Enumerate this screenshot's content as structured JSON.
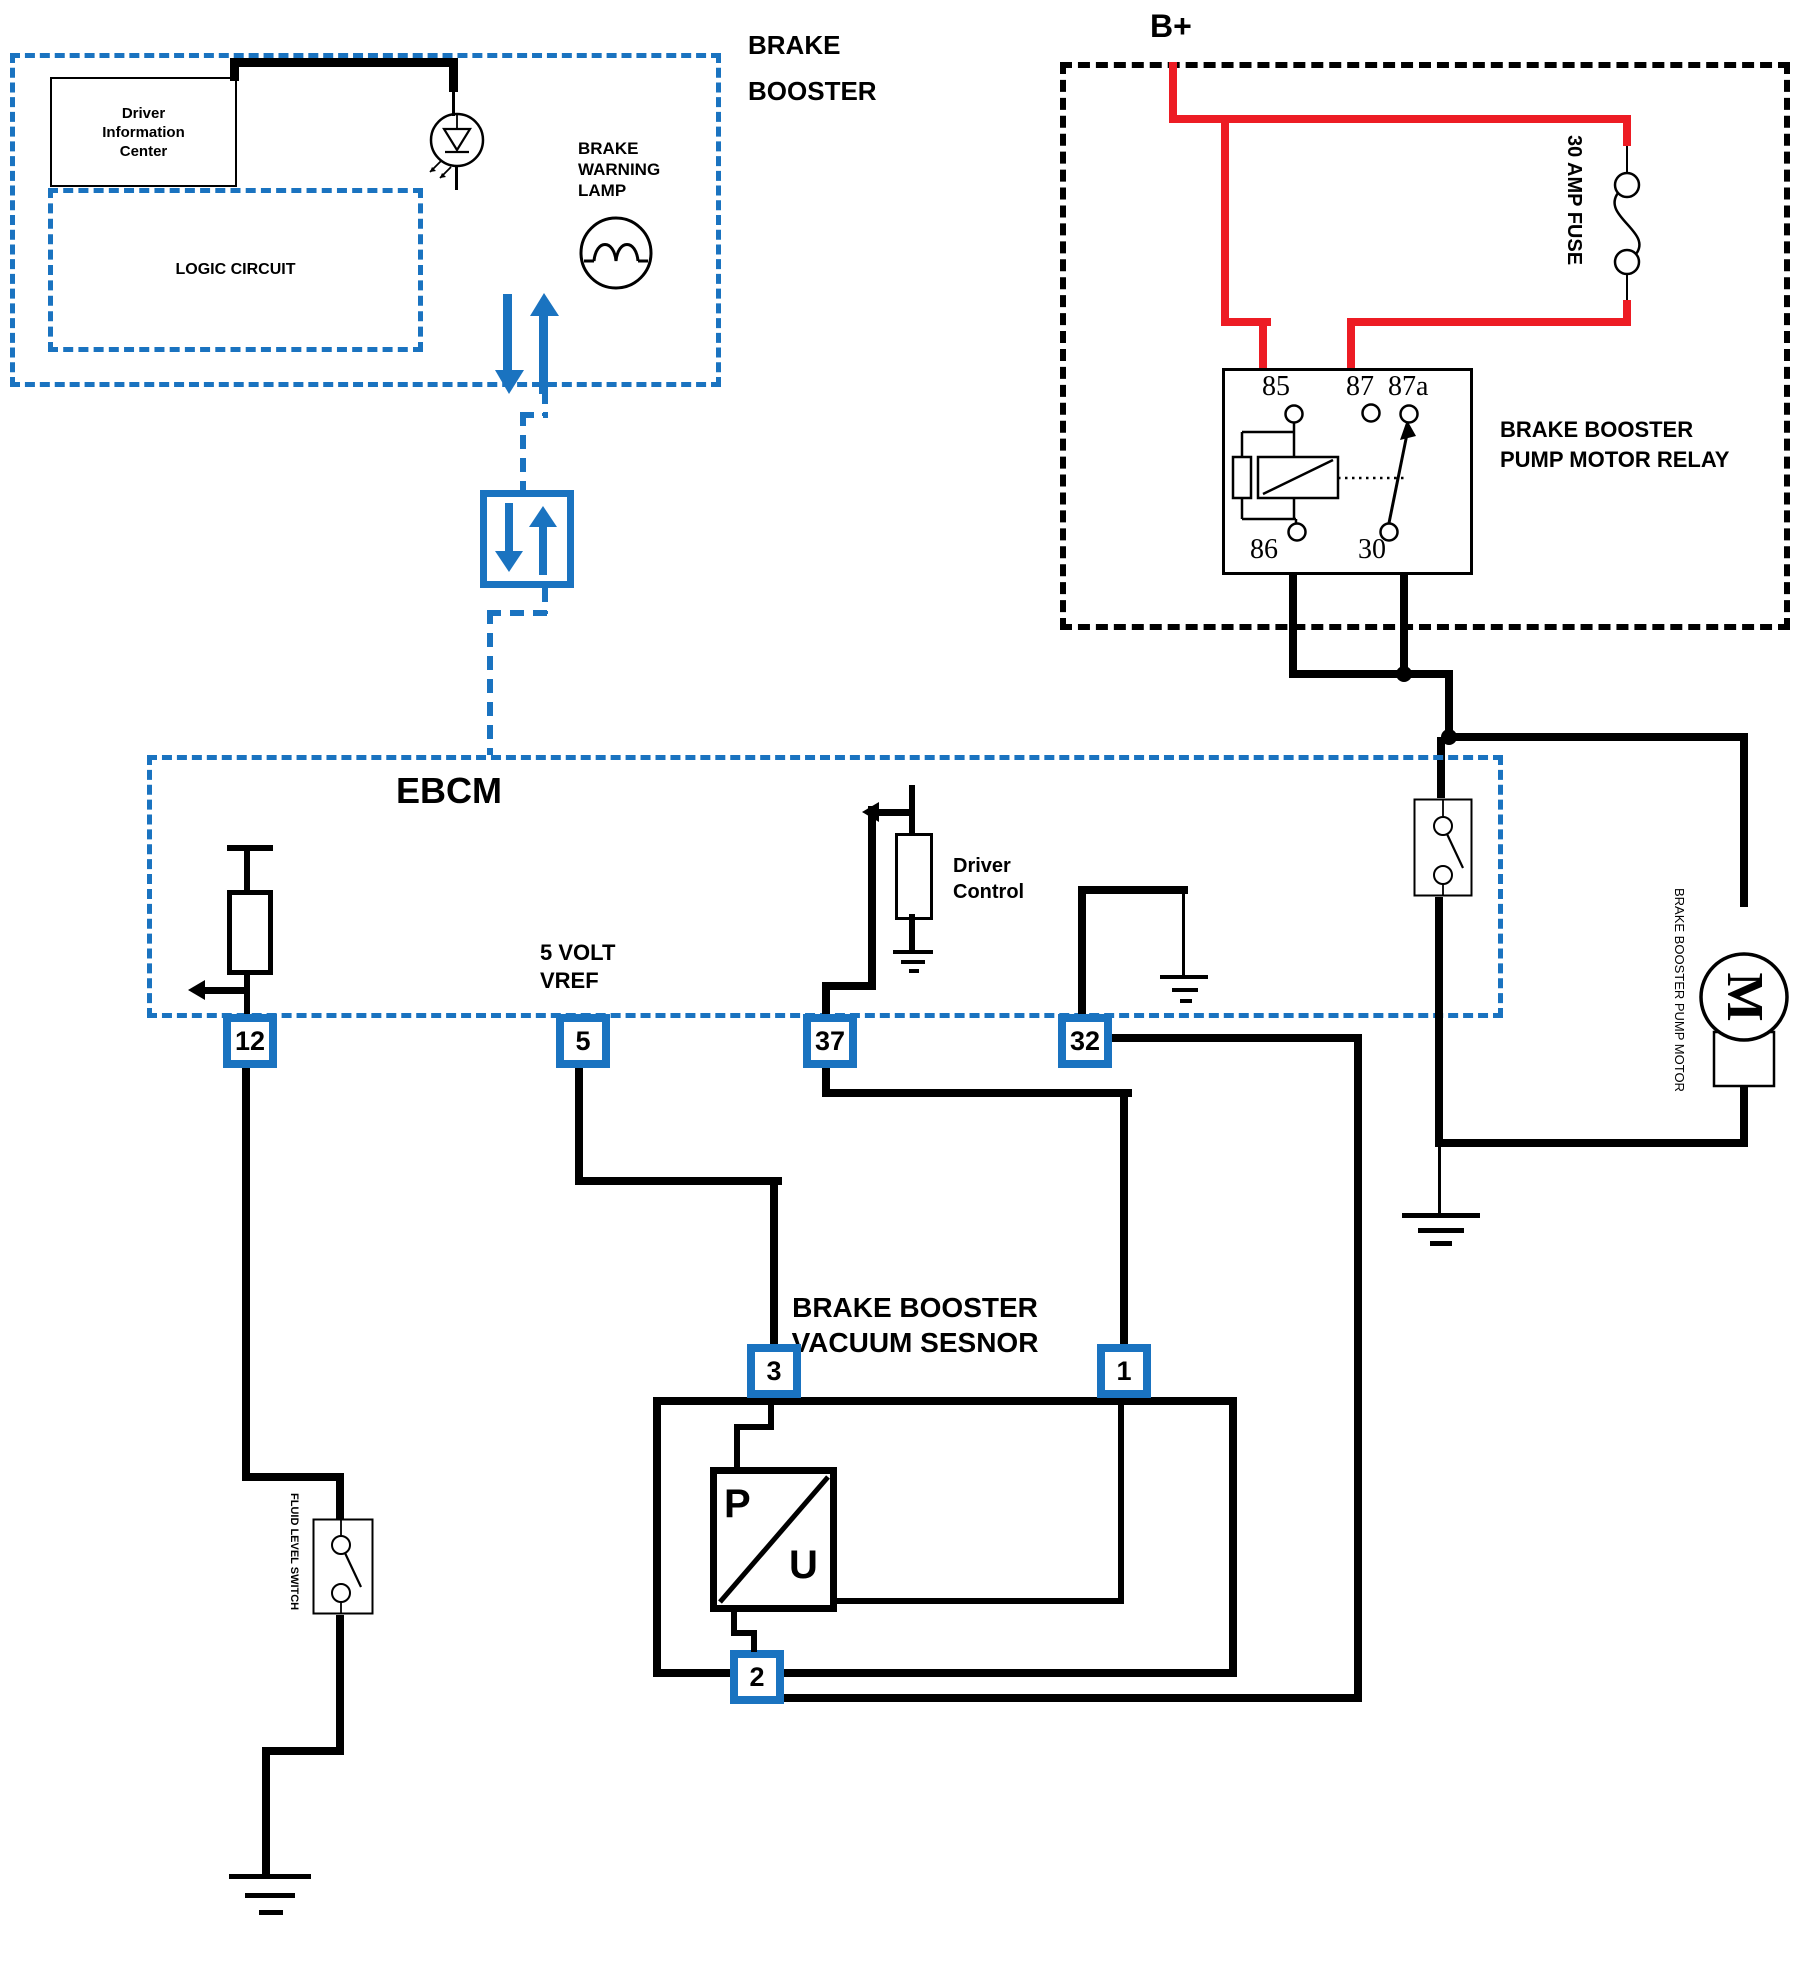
{
  "colors": {
    "blue": "#1a73c0",
    "red": "#ed1c24",
    "black": "#000000"
  },
  "brake_booster": {
    "label": [
      "BRAKE",
      "BOOSTER"
    ],
    "driver_info_center": [
      "Driver",
      "Information",
      "Center"
    ],
    "logic_circuit": "LOGIC CIRCUIT",
    "warning_lamp": [
      "BRAKE",
      "WARNING",
      "LAMP"
    ]
  },
  "power": {
    "b_plus": "B+",
    "fuse": "30 AMP FUSE"
  },
  "relay": {
    "name": [
      "BRAKE BOOSTER",
      "PUMP MOTOR RELAY"
    ],
    "pins": {
      "p85": "85",
      "p87": "87",
      "p87a": "87a",
      "p86": "86",
      "p30": "30"
    }
  },
  "ebcm": {
    "name": "EBCM",
    "vref": [
      "5 VOLT",
      "VREF"
    ],
    "driver_control": [
      "Driver",
      "Control"
    ],
    "pins": {
      "p12": "12",
      "p5": "5",
      "p37": "37",
      "p32": "32"
    }
  },
  "sensor": {
    "name": [
      "BRAKE BOOSTER",
      "VACUUM SESNOR"
    ],
    "pins": {
      "p3": "3",
      "p1": "1",
      "p2": "2"
    },
    "p": "P",
    "u": "U"
  },
  "motor": {
    "m": "M",
    "label": "BRAKE BOOSTER PUMP MOTOR"
  },
  "fluid_level_switch": {
    "label": "FLUID LEVEL SWITCH"
  }
}
